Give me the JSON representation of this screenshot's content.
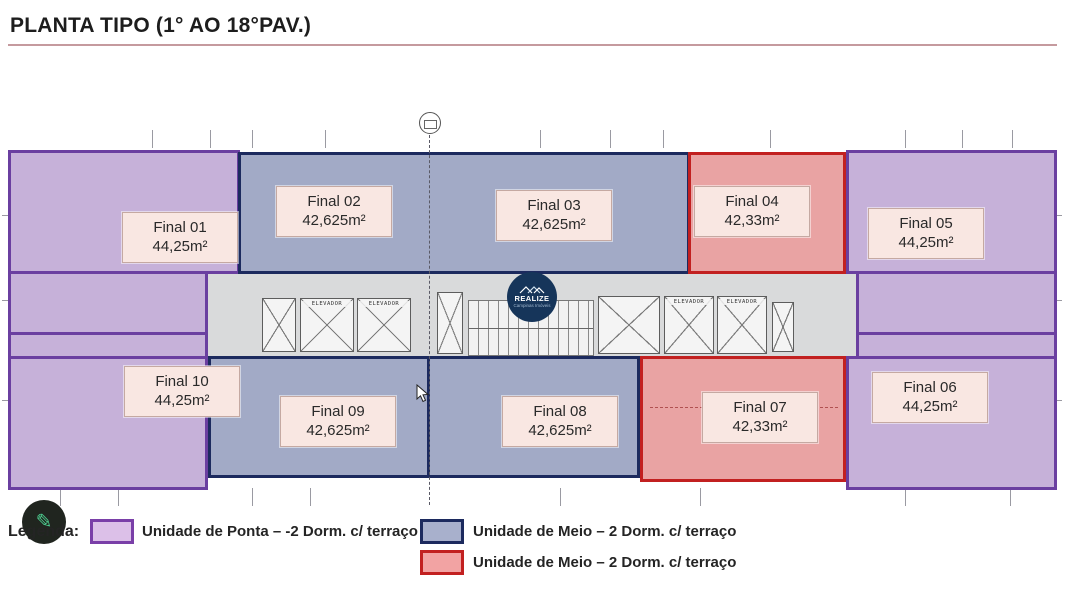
{
  "title": "PLANTA TIPO (1° AO 18°PAV.)",
  "logo": {
    "brand": "REALIZE",
    "tagline": "Campinas Imóveis"
  },
  "plan": {
    "elevator_label": "ELEVADOR",
    "units": [
      {
        "label": "Final 01",
        "area": "44,25m²",
        "type": "ponta",
        "rooms": [
          "DORMIT 1",
          "DORMIT 2",
          "VARANDA",
          "ESTAR",
          "BH",
          "JANTAR",
          "COZ."
        ]
      },
      {
        "label": "Final 02",
        "area": "42,625m²",
        "type": "meio-azul",
        "rooms": [
          "ESTAR",
          "DORMIT 2",
          "DORMIT 1",
          "JANTAR"
        ]
      },
      {
        "label": "Final 03",
        "area": "42,625m²",
        "type": "meio-azul",
        "rooms": [
          "DORMIT 2",
          "ESTAR",
          "DORMIT 1",
          "JANTAR",
          "COZ."
        ]
      },
      {
        "label": "Final 04",
        "area": "42,33m²",
        "type": "meio-vermelho",
        "rooms": [
          "DORMIT 2",
          "ESTAR",
          "JANTAR",
          "COZ."
        ]
      },
      {
        "label": "Final 05",
        "area": "44,25m²",
        "type": "ponta",
        "rooms": [
          "VARANDA",
          "ESTAR",
          "DORMIT 2",
          "DORMIT 1",
          "JANTAR",
          "COZ."
        ]
      },
      {
        "label": "Final 06",
        "area": "44,25m²",
        "type": "ponta",
        "rooms": [
          "COZ.",
          "DORMIT 1",
          "ESTAR",
          "DORMIT 2",
          "VARANDA"
        ]
      },
      {
        "label": "Final 07",
        "area": "42,33m²",
        "type": "meio-vermelho",
        "rooms": [
          "DORMIT. 1",
          "JANTAR",
          "COZ.",
          "DORMIT. 2",
          "ESTAR"
        ]
      },
      {
        "label": "Final 08",
        "area": "42,625m²",
        "type": "meio-azul",
        "rooms": [
          "DORMIT. 1",
          "JANTAR",
          "COZ.",
          "DORMIT 2"
        ]
      },
      {
        "label": "Final 09",
        "area": "42,625m²",
        "type": "meio-azul",
        "rooms": [
          "JANTAR",
          "DORMIT. 1",
          "ESTAR",
          "DORMIT 2"
        ]
      },
      {
        "label": "Final 10",
        "area": "44,25m²",
        "type": "ponta",
        "rooms": [
          "COZ.",
          "DORMIT 1",
          "BH",
          "ESTAR",
          "DORMIT 2",
          "VARANDA"
        ]
      }
    ]
  },
  "legend": {
    "heading": "Legenda:",
    "items": [
      {
        "label": "Unidade de Ponta –  -2 Dorm. c/ terraço",
        "fill": "#dcc0e8",
        "border": "#7a3fa8"
      },
      {
        "label": "Unidade de Meio – 2 Dorm. c/ terraço",
        "fill": "#a8b0cc",
        "border": "#1c2a5e"
      },
      {
        "label": "Unidade de Meio – 2 Dorm. c/ terraço",
        "fill": "#f2a3a3",
        "border": "#c22020"
      }
    ]
  },
  "colors": {
    "ponta_fill": "#c6b1d9",
    "ponta_border": "#6a3fa0",
    "meio_azul_fill": "#a2aac6",
    "meio_azul_border": "#1c2a5e",
    "meio_vermelho_fill": "#e9a3a3",
    "meio_vermelho_border": "#c22020",
    "corridor_fill": "#d9dadb",
    "card_fill": "#f9e7e2",
    "title_underline": "#c59a9e",
    "logo_bg": "#16355a",
    "pencil_green": "#4ccb8e"
  }
}
